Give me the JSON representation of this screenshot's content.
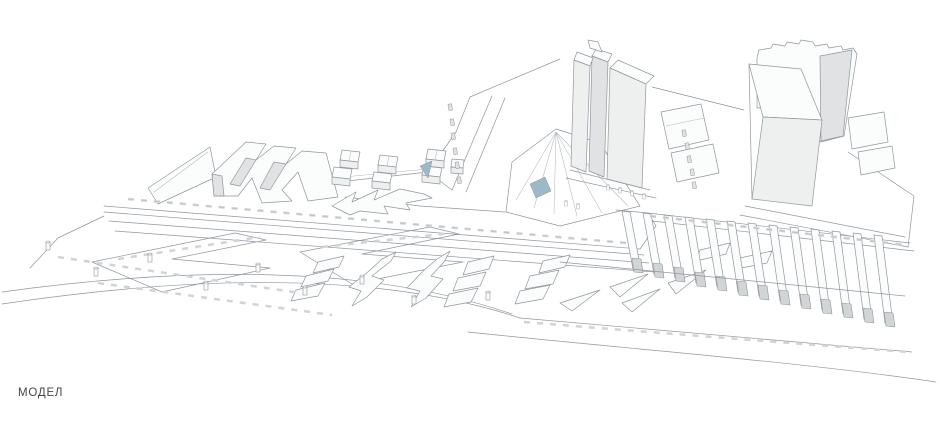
{
  "label": {
    "text": "МОДЕЛ"
  },
  "colors": {
    "line": "#8f979e",
    "line_soft": "#b3bac0",
    "face_white": "#fbfcfc",
    "face_light": "#eef0f0",
    "face_mid": "#e0e2e3",
    "face_dark": "#d2d5d6",
    "accent_blue": "#9db8c8",
    "label_text": "#43474b",
    "bg": "#ffffff"
  }
}
